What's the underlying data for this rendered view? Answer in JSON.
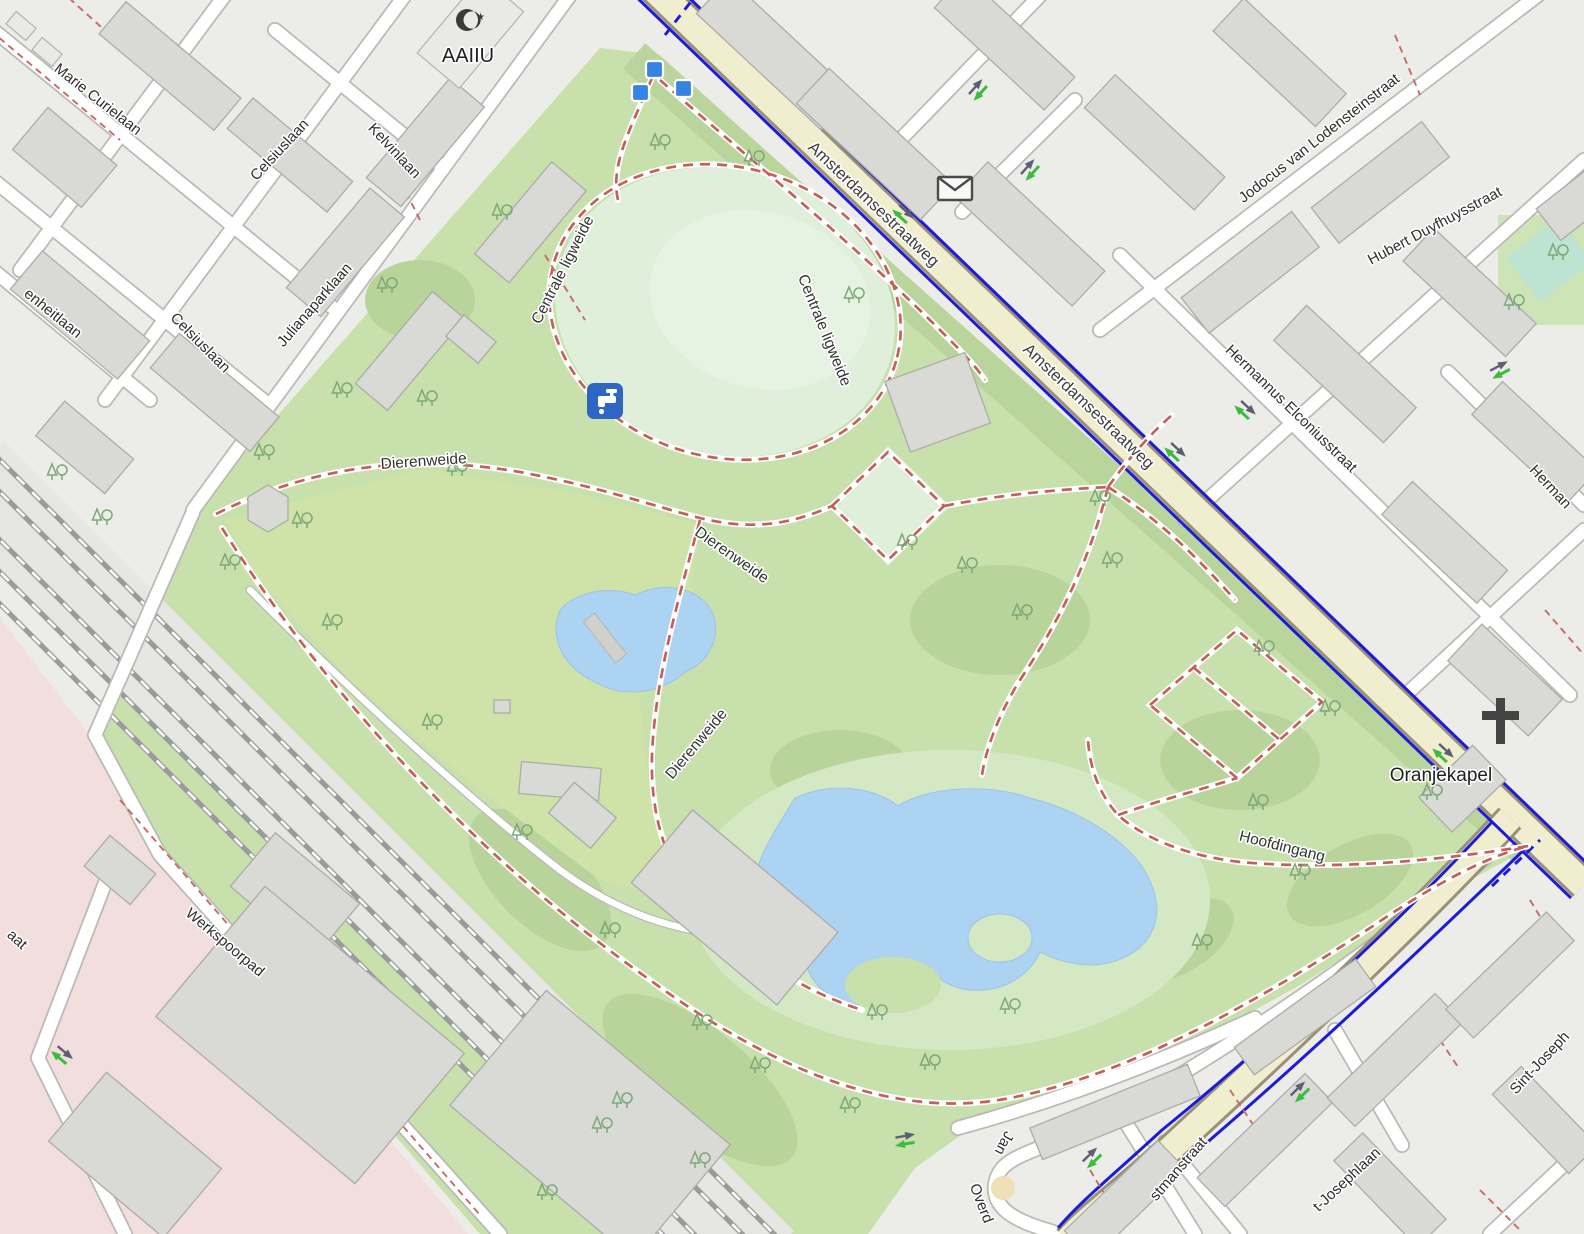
{
  "map": {
    "kind": "street-map of a city park with surrounding neighbourhoods",
    "colors": {
      "water": "#ACD3F2",
      "park_green": "#C8E0AC",
      "meadow_green": "#CFE3A8",
      "scrub_green": "#B9D49B",
      "ligweide_pale": "#DFEFDA",
      "residential_gray": "#ECECE9",
      "industrial_pink": "#F2DEDC",
      "building_gray": "#D9D9D6",
      "main_road_beige": "#F1EDCF",
      "main_road_casing": "#9A9078",
      "cycleway_blue": "#1B1BD9",
      "footpath_red": "#C4605C",
      "railway_gray": "#9B9B9B",
      "node_marker_blue": "#3584E4",
      "poi_blue": "#2F66C4",
      "oneway_green": "#3DBB3D",
      "oneway_gray": "#5B5F75",
      "pool_teal": "#BDE3D3",
      "label_dark": "#2E2E2E"
    },
    "streets": [
      {
        "text": "Marie Curielaan"
      },
      {
        "text": "Celsiuslaan"
      },
      {
        "text": "Kelvinlaan"
      },
      {
        "text": "Julianaparklaan"
      },
      {
        "text": "Celsiuslaan"
      },
      {
        "text": "enheitlaan"
      },
      {
        "text": "aat"
      },
      {
        "text": "Amsterdamsestraatweg"
      },
      {
        "text": "Amsterdamsestraatweg"
      },
      {
        "text": "Jodocus van Lodensteinstraat"
      },
      {
        "text": "Hubert Duyfhuysstraat"
      },
      {
        "text": "Hermannus Elconiusstraat"
      },
      {
        "text": "Herman"
      },
      {
        "text": "Werkspoorpad"
      },
      {
        "text": "t-Josephlaan"
      },
      {
        "text": "Sint-Joseph"
      },
      {
        "text": "stmanstraat"
      },
      {
        "text": "Jan"
      },
      {
        "text": "Overd"
      }
    ],
    "park_labels": [
      {
        "text": "Centrale ligweide"
      },
      {
        "text": "Centrale ligweide"
      },
      {
        "text": "Dierenweide"
      },
      {
        "text": "Dierenweide"
      },
      {
        "text": "Dierenweide"
      },
      {
        "text": "Hoofdingang"
      }
    ],
    "pois": [
      {
        "name": "AAIIU",
        "icon": "mosque-icon"
      },
      {
        "name": "Oranjekapel",
        "icon": "church-cross-icon"
      }
    ],
    "icons": [
      {
        "name": "mosque-icon"
      },
      {
        "name": "church-cross-icon"
      },
      {
        "name": "drinking-water-icon"
      },
      {
        "name": "postbox-icon"
      },
      {
        "name": "node-marker-icon",
        "count": 3
      },
      {
        "name": "oneway-arrow-icon"
      },
      {
        "name": "tree-icon"
      }
    ]
  }
}
